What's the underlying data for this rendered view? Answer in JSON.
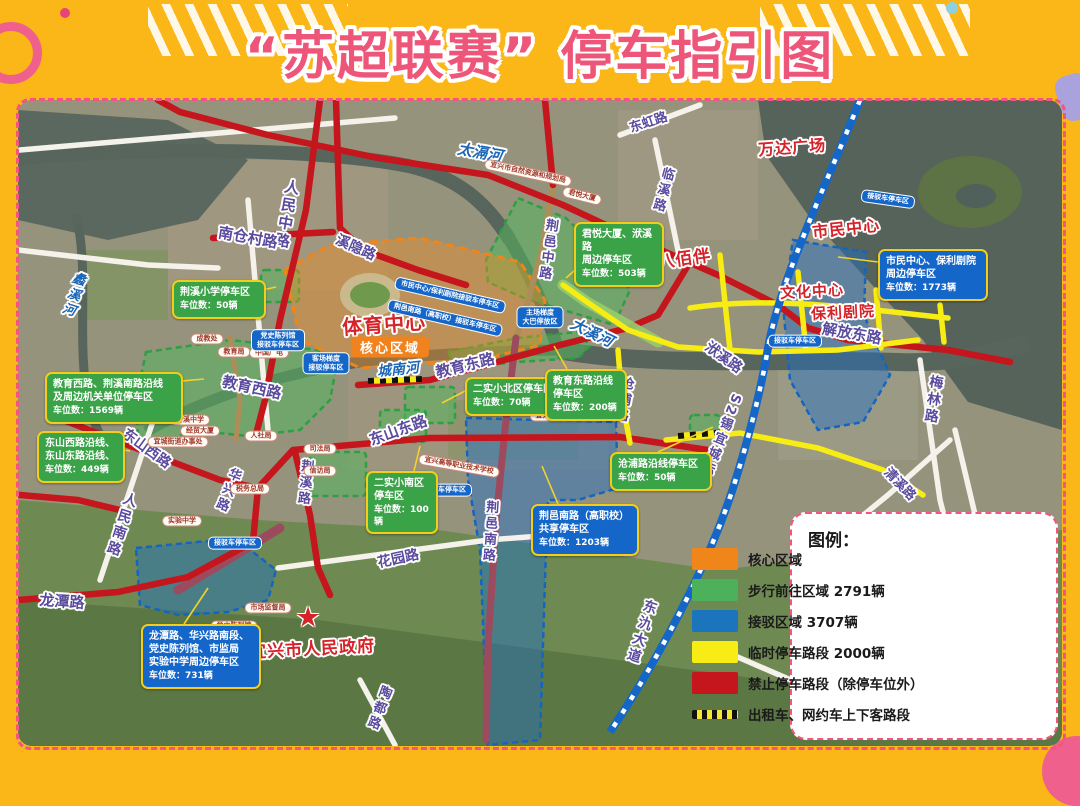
{
  "page": {
    "title": "“苏超联赛” 停车指引图"
  },
  "legend": {
    "title": "图例：",
    "items": [
      {
        "swatch": "#F08519",
        "label": "核心区域"
      },
      {
        "swatch": "#4DB05A",
        "label": "步行前往区域 2791辆"
      },
      {
        "swatch": "#1B75BC",
        "label": "接驳区域 3707辆"
      },
      {
        "swatch": "#F7EC13",
        "label": "临时停车路段 2000辆"
      },
      {
        "swatch": "#C4161C",
        "label": "禁止停车路段（除停车位外）"
      },
      {
        "swatch": "dashed",
        "label": "出租车、网约车上下客路段"
      }
    ]
  },
  "map": {
    "core_badge": {
      "text": "核心区域",
      "x": 372,
      "y": 247
    },
    "star": {
      "glyph": "★",
      "x": 290,
      "y": 517
    },
    "road_labels": [
      {
        "text": "人民中路",
        "x": 269,
        "y": 115,
        "rot": 10,
        "v": true,
        "fs": 15
      },
      {
        "text": "南仓村路",
        "x": 230,
        "y": 137,
        "rot": 10,
        "fs": 15
      },
      {
        "text": "溪隐路",
        "x": 338,
        "y": 147,
        "rot": 24,
        "fs": 14
      },
      {
        "text": "东虹路",
        "x": 630,
        "y": 21,
        "rot": -18,
        "fs": 13
      },
      {
        "text": "临溪路",
        "x": 644,
        "y": 90,
        "rot": 15,
        "v": true,
        "fs": 13
      },
      {
        "text": "荆邑中路",
        "x": 529,
        "y": 150,
        "rot": 8,
        "v": true,
        "fs": 13
      },
      {
        "text": "解放东路",
        "x": 834,
        "y": 233,
        "rot": 10,
        "fs": 15
      },
      {
        "text": "洑溪路",
        "x": 706,
        "y": 257,
        "rot": 36,
        "fs": 14
      },
      {
        "text": "梅林路",
        "x": 915,
        "y": 300,
        "rot": 8,
        "v": true,
        "fs": 14
      },
      {
        "text": "S2锡宜城际",
        "x": 702,
        "y": 335,
        "rot": 22,
        "v": true,
        "fs": 13
      },
      {
        "text": "教育东路",
        "x": 447,
        "y": 265,
        "rot": -14,
        "fs": 15
      },
      {
        "text": "教育西路",
        "x": 234,
        "y": 287,
        "rot": 12,
        "fs": 15
      },
      {
        "text": "东山西路",
        "x": 129,
        "y": 348,
        "rot": 36,
        "fs": 14
      },
      {
        "text": "东山东路",
        "x": 380,
        "y": 330,
        "rot": -20,
        "fs": 15
      },
      {
        "text": "人民南路",
        "x": 103,
        "y": 425,
        "rot": 18,
        "v": true,
        "fs": 14
      },
      {
        "text": "华兴路",
        "x": 209,
        "y": 390,
        "rot": 22,
        "v": true,
        "fs": 13
      },
      {
        "text": "荆溪路",
        "x": 286,
        "y": 383,
        "rot": 6,
        "v": true,
        "fs": 13
      },
      {
        "text": "花园路",
        "x": 380,
        "y": 458,
        "rot": -12,
        "fs": 14
      },
      {
        "text": "龙潭路",
        "x": 44,
        "y": 501,
        "rot": 4,
        "fs": 15
      },
      {
        "text": "陶都路",
        "x": 360,
        "y": 608,
        "rot": 20,
        "v": true,
        "fs": 13
      },
      {
        "text": "荆邑南路",
        "x": 471,
        "y": 432,
        "rot": 4,
        "v": true,
        "fs": 13
      },
      {
        "text": "沧浦路",
        "x": 605,
        "y": 300,
        "rot": 10,
        "v": true,
        "fs": 13
      },
      {
        "text": "东氿大道",
        "x": 623,
        "y": 532,
        "rot": 18,
        "v": true,
        "fs": 14
      },
      {
        "text": "清溪路",
        "x": 883,
        "y": 383,
        "rot": 46,
        "fs": 13
      }
    ],
    "river_labels": [
      {
        "text": "太滆河",
        "x": 462,
        "y": 52,
        "rot": 10,
        "fs": 15
      },
      {
        "text": "大溪河",
        "x": 574,
        "y": 232,
        "rot": 26,
        "fs": 15
      },
      {
        "text": "城南河",
        "x": 380,
        "y": 269,
        "rot": -6,
        "fs": 14
      },
      {
        "text": "蠡溪河",
        "x": 55,
        "y": 195,
        "rot": 18,
        "v": true,
        "fs": 13
      }
    ],
    "landmark_labels": [
      {
        "text": "万达广场",
        "x": 774,
        "y": 46,
        "rot": -4,
        "fs": 16
      },
      {
        "text": "八佰伴",
        "x": 666,
        "y": 157,
        "rot": -8,
        "fs": 17
      },
      {
        "text": "市民中心",
        "x": 828,
        "y": 127,
        "rot": -6,
        "fs": 16
      },
      {
        "text": "文化中心",
        "x": 794,
        "y": 191,
        "rot": -3,
        "fs": 15
      },
      {
        "text": "保利剧院",
        "x": 825,
        "y": 212,
        "rot": -3,
        "fs": 15
      },
      {
        "text": "体育中心",
        "x": 366,
        "y": 223,
        "rot": -4,
        "fs": 20
      },
      {
        "text": "宜兴市人民政府",
        "x": 294,
        "y": 547,
        "rot": -3,
        "fs": 17
      }
    ],
    "callouts": [
      {
        "cls": "green",
        "anchor": "tl",
        "x": 154,
        "y": 180,
        "w": 78,
        "lines": "荆溪小学停车区",
        "count": "车位数：50辆"
      },
      {
        "cls": "green",
        "anchor": "tl",
        "x": 556,
        "y": 122,
        "w": 74,
        "lines": "君悦大厦、洑溪路\n周边停车区",
        "count": "车位数：503辆"
      },
      {
        "cls": "green",
        "anchor": "tl",
        "x": 27,
        "y": 272,
        "w": 122,
        "lines": "教育西路、荆溪南路沿线\n及周边机关单位停车区",
        "count": "车位数：1569辆"
      },
      {
        "cls": "green",
        "anchor": "tl",
        "x": 19,
        "y": 331,
        "w": 72,
        "lines": "东山西路沿线、\n东山东路沿线、",
        "count": "车位数：449辆"
      },
      {
        "cls": "green",
        "anchor": "tl",
        "x": 447,
        "y": 277,
        "w": 86,
        "lines": "二实小北区停车区",
        "count": "车位数：70辆"
      },
      {
        "cls": "green",
        "anchor": "tl",
        "x": 527,
        "y": 269,
        "w": 66,
        "lines": "教育东路沿线\n停车区",
        "count": "车位数：200辆"
      },
      {
        "cls": "green",
        "anchor": "tl",
        "x": 348,
        "y": 371,
        "w": 56,
        "lines": "二实小南区\n停车区",
        "count": "车位数：100辆"
      },
      {
        "cls": "green",
        "anchor": "tl",
        "x": 592,
        "y": 352,
        "w": 86,
        "lines": "沧浦路沿线停车区",
        "count": "车位数：50辆"
      },
      {
        "cls": "blue",
        "anchor": "tl",
        "x": 860,
        "y": 149,
        "w": 94,
        "lines": "市民中心、保利剧院\n周边停车区",
        "count": "车位数：1773辆"
      },
      {
        "cls": "blue",
        "anchor": "tl",
        "x": 513,
        "y": 404,
        "w": 92,
        "lines": "荆邑南路（高职校）\n共享停车区",
        "count": "车位数：1203辆"
      },
      {
        "cls": "blue",
        "anchor": "tl",
        "x": 123,
        "y": 524,
        "w": 104,
        "lines": "龙潭路、华兴路南段、\n党史陈列馆、市监局\n实验中学周边停车区",
        "count": "车位数：731辆"
      }
    ],
    "shuttle_tags": [
      {
        "text": "市民中心/保利剧院接驳车停车区",
        "x": 432,
        "y": 195,
        "rot": 13
      },
      {
        "text": "荆邑南路（高职校）接驳车停车区",
        "x": 427,
        "y": 218,
        "rot": 13
      },
      {
        "text": "主场梯度\n大巴停放区",
        "x": 522,
        "y": 217,
        "rot": 0
      },
      {
        "text": "客场梯度\n接驳停车区",
        "x": 308,
        "y": 263,
        "rot": 0
      },
      {
        "text": "党史陈列馆\n接驳车停车区",
        "x": 260,
        "y": 240,
        "rot": 0
      },
      {
        "text": "接驳车停车区",
        "x": 870,
        "y": 99,
        "rot": 8
      },
      {
        "text": "接驳车停车区",
        "x": 777,
        "y": 241,
        "rot": 0
      },
      {
        "text": "接驳车停车区",
        "x": 427,
        "y": 390,
        "rot": 0
      },
      {
        "text": "接驳车停车区",
        "x": 217,
        "y": 443,
        "rot": 0
      }
    ],
    "facility_tags": [
      {
        "text": "宜兴市自然资源和规划局",
        "x": 510,
        "y": 73,
        "rot": 12
      },
      {
        "text": "君悦大厦",
        "x": 564,
        "y": 96,
        "rot": 14
      },
      {
        "text": "成教处",
        "x": 189,
        "y": 239,
        "rot": 0
      },
      {
        "text": "教育局",
        "x": 216,
        "y": 252,
        "rot": 0
      },
      {
        "text": "中国广电",
        "x": 251,
        "y": 253,
        "rot": 0
      },
      {
        "text": "升溪中学",
        "x": 172,
        "y": 320,
        "rot": 0
      },
      {
        "text": "经贸大厦",
        "x": 182,
        "y": 331,
        "rot": 0
      },
      {
        "text": "宜城街道办事处",
        "x": 160,
        "y": 342,
        "rot": 0
      },
      {
        "text": "人社局",
        "x": 243,
        "y": 336,
        "rot": 0
      },
      {
        "text": "税务总局",
        "x": 232,
        "y": 389,
        "rot": 0
      },
      {
        "text": "实验中学",
        "x": 164,
        "y": 421,
        "rot": 0
      },
      {
        "text": "宜兴市人才服务中心",
        "x": 549,
        "y": 316,
        "rot": 0
      },
      {
        "text": "宜兴高等职业技术学校",
        "x": 441,
        "y": 366,
        "rot": 10
      },
      {
        "text": "市场监督局",
        "x": 250,
        "y": 508,
        "rot": 0
      },
      {
        "text": "党史陈列馆",
        "x": 216,
        "y": 526,
        "rot": 0
      },
      {
        "text": "司法局",
        "x": 302,
        "y": 349,
        "rot": 0
      },
      {
        "text": "信访局",
        "x": 302,
        "y": 371,
        "rot": 0
      }
    ]
  }
}
